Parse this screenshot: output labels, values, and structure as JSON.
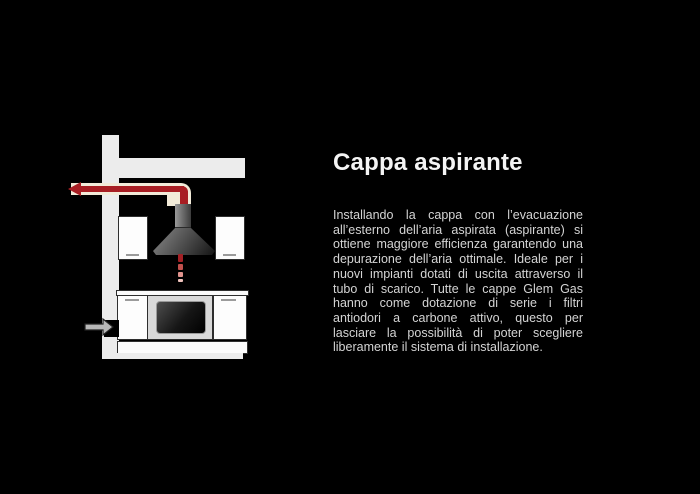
{
  "slide": {
    "background_color": "#000000",
    "title": "Cappa aspirante",
    "body": "Installando la cappa con l’evacuazione all’esterno dell’aria aspirata (aspirante) si ottiene maggiore efficienza garantendo una depurazione dell’aria ottimale. Ideale per i nuovi impianti dotati di uscita attraverso il tubo di scarico. Tutte le cappe Glem Gas hanno come dotazione di serie i filtri antiodori a carbone attivo, questo per lasciare la possibilità di poter scegliere liberamente il sistema di installazione."
  },
  "diagram": {
    "name": "ducted-extraction-installation-diagram",
    "depicts": "cooker hood venting air through a wall duct to the outside, with air intake arrow at floor level",
    "elements": [
      "wall",
      "soffit",
      "exhaust-duct",
      "exhaust-arrow",
      "cooker-hood",
      "suction-dashes",
      "wall-cabinet-left",
      "wall-cabinet-right",
      "countertop",
      "base-cabinet-left",
      "oven",
      "base-cabinet-right",
      "plinth",
      "floor",
      "air-intake-arrow"
    ],
    "colors": {
      "wall": "#ececec",
      "cabinet": "#fdfdfd",
      "outline": "#2e2e2e",
      "duct_pipe": "#f2ebd9",
      "exhaust_arrow": "#a81e23",
      "intake_arrow": "#b8b8b8",
      "oven_panel": "#d9d9d9",
      "hood_light": "#8a8a8a",
      "hood_dark": "#141414",
      "handle": "#9b9b9b"
    }
  }
}
